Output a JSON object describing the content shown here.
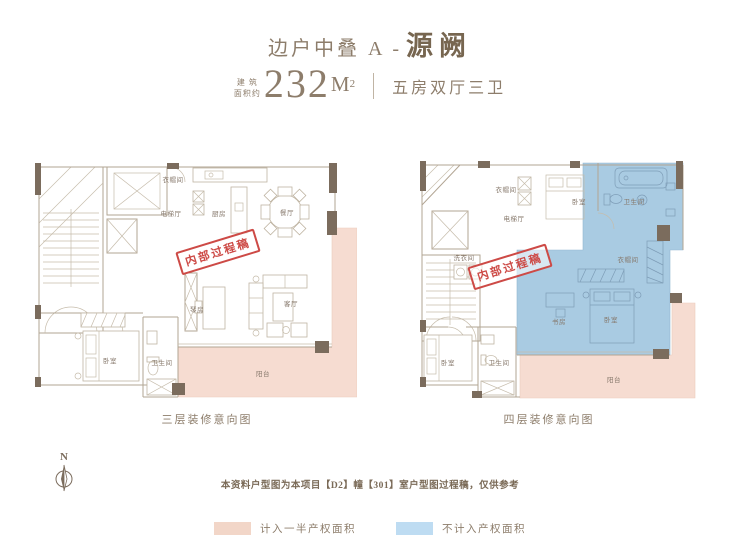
{
  "header": {
    "title_prefix": "边户中叠 A -",
    "title_name": "源阙",
    "area_label_line1": "建 筑",
    "area_label_line2": "面积约",
    "area_value": "232",
    "area_unit_m": "M",
    "area_unit_sup": "2",
    "spec": "五房双厅三卫"
  },
  "stamp_text": "内部过程稿",
  "plans": [
    {
      "caption": "三层装修意向图",
      "labels": {
        "closet": "衣帽间",
        "elevator": "电梯厅",
        "kitchen": "厨房",
        "dining": "餐厅",
        "living": "客厅",
        "piano": "琴房",
        "bedroom": "卧室",
        "bathroom": "卫生间",
        "balcony": "阳台"
      }
    },
    {
      "caption": "四层装修意向图",
      "labels": {
        "closet": "衣帽间",
        "elevator": "电梯厅",
        "laundry": "洗衣间",
        "bedroom_top": "卧室",
        "bathroom_top": "卫生间",
        "closet_right": "衣帽间",
        "study": "书房",
        "bedroom_master": "卧室",
        "bedroom_lower": "卧室",
        "bathroom_lower": "卫生间",
        "balcony": "阳台"
      }
    }
  ],
  "compass": {
    "label": "N"
  },
  "disclaimer": "本资料户型图为本项目【D2】幢【301】室户型图过程稿，仅供参考",
  "legend": [
    {
      "label": "计入一半产权面积",
      "color": "#f2d6c8"
    },
    {
      "label": "不计入产权面积",
      "color": "#bedcf2"
    }
  ],
  "colors": {
    "title_brown": "#8a7a66",
    "wall_dark": "#7b6c5d",
    "plan_line": "#b2a593",
    "half_area_fill": "#f6dcd1",
    "excluded_area_fill": "#a9cbe2",
    "stamp_red": "#cd4a46"
  }
}
